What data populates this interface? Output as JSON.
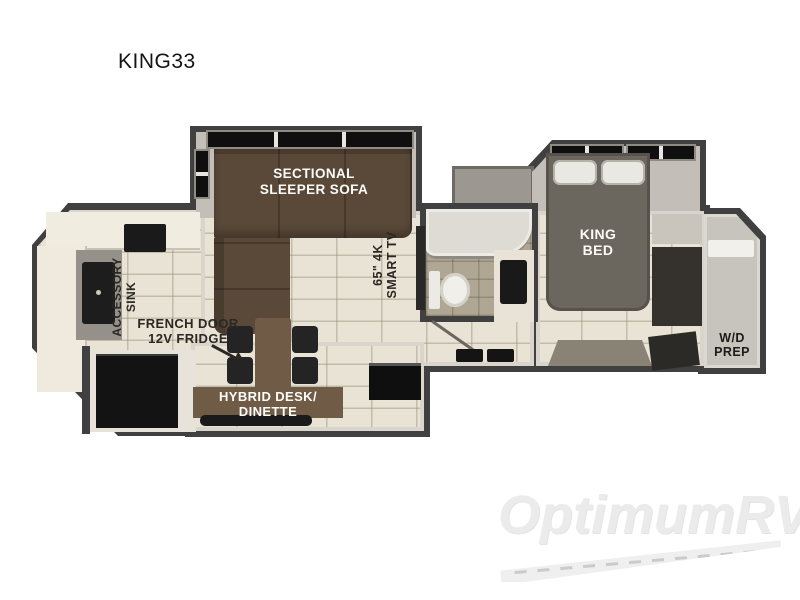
{
  "title": "KING33",
  "watermark": {
    "brand": "OptimumRV"
  },
  "plan": {
    "sofa": {
      "line1": "SECTIONAL",
      "line2": "SLEEPER SOFA"
    },
    "tv": {
      "line1": "65\" 4K",
      "line2": "SMART TV"
    },
    "accessory_sink": {
      "line1": "ACCESSORY",
      "line2": "SINK"
    },
    "fridge": {
      "line1": "FRENCH DOOR",
      "line2": "12V FRIDGE"
    },
    "dinette": {
      "line1": "HYBRID DESK/",
      "line2": "DINETTE"
    },
    "king_bed": {
      "line1": "KING",
      "line2": "BED"
    },
    "wd_prep": {
      "line1": "W/D",
      "line2": "PREP"
    }
  },
  "colors": {
    "wall": "#404040",
    "floor_tile": "#e8e3d4",
    "bath_floor": "#b0a694",
    "sofa": "#5a4939",
    "bed": "#6b665e",
    "table": "#6f5b46",
    "appliance_black": "#131313",
    "label_dark": "#2b2723",
    "label_light": "#fdfcf8",
    "watermark": "#ebebeb"
  }
}
